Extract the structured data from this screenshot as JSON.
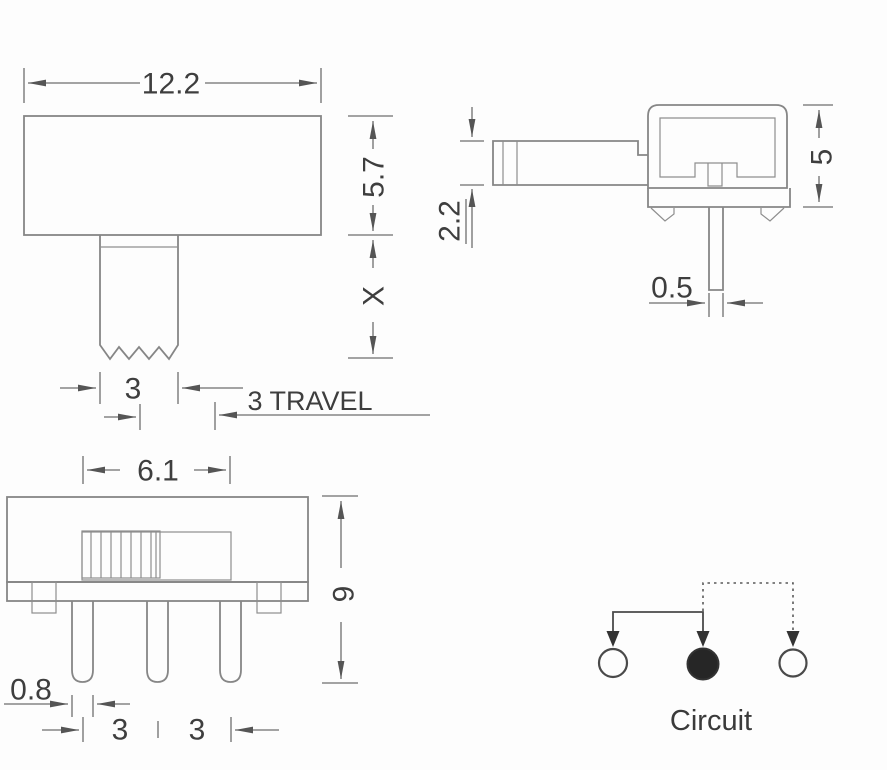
{
  "drawing": {
    "title": "Slide switch technical drawing",
    "front_view": {
      "dim_width": "12.2",
      "dim_body_height": "5.7",
      "dim_stem_height": "X",
      "dim_stem_width": "3",
      "dim_travel": "3 TRAVEL"
    },
    "side_view": {
      "dim_lever_thickness": "2.2",
      "dim_body_height": "5",
      "dim_pin_width": "0.5"
    },
    "top_view": {
      "dim_slot_width": "6.1",
      "dim_total_height": "9",
      "dim_pin_width": "0.8",
      "dim_pitch_1": "3",
      "dim_pitch_2": "3"
    },
    "circuit": {
      "caption": "Circuit"
    },
    "colors": {
      "background": "#fdfdfd",
      "outline": "#868686",
      "dimension_line": "#6e6e6e",
      "text": "#3e3e3e",
      "circuit_line": "#4a4a4a",
      "filled_node": "#262626"
    }
  }
}
